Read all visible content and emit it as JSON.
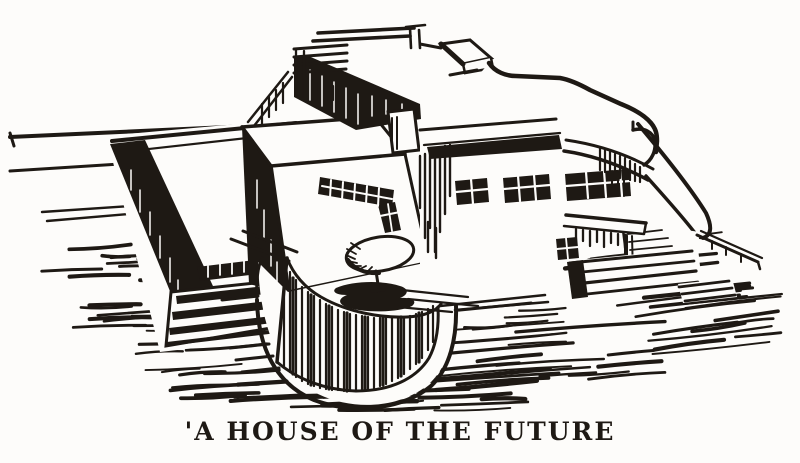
{
  "figure": {
    "caption": "'A HOUSE OF THE FUTURE",
    "alt_text": "Pen-and-ink perspective drawing of a flat-roofed modernist house with rooftop sun-deck railing, corner strip windows, a curved streamlined wing, entrance canopy with steps, and a rounded terrace with an umbrella table",
    "style": {
      "ink": "#1e1914",
      "paper": "#fdfcfa"
    }
  }
}
